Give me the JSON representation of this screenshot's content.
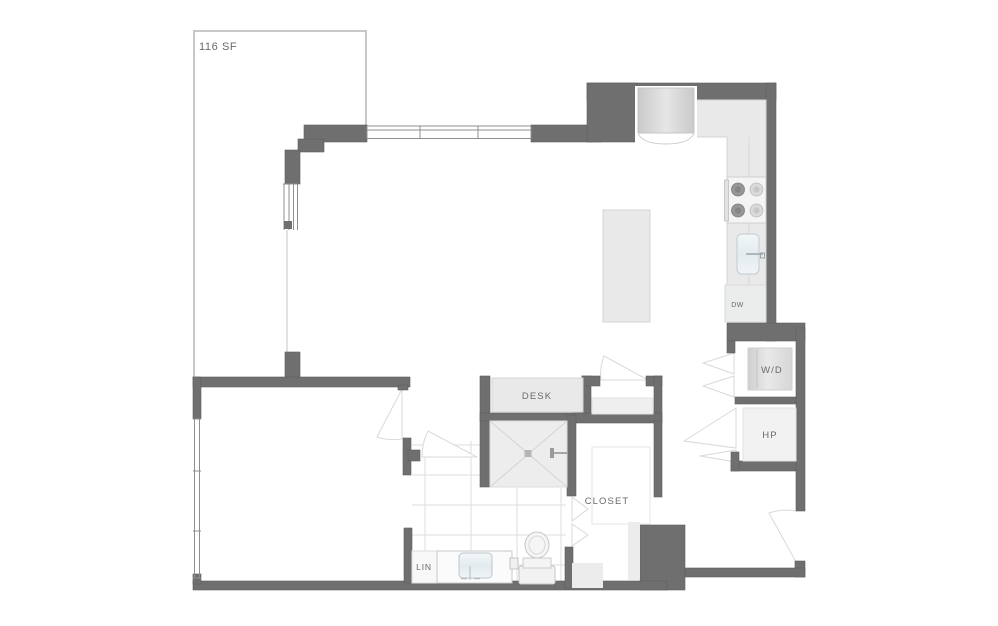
{
  "floorplan": {
    "balcony": {
      "area_label": "116 SF"
    },
    "labels": {
      "desk": "DESK",
      "closet": "CLOSET",
      "linen": "LIN",
      "washer_dryer": "W/D",
      "heat_pump": "HP",
      "dishwasher": "DW"
    },
    "colors": {
      "background": "#ffffff",
      "wall": "#6f6f6f",
      "wall_edge": "#5f5f5f",
      "fixture_fill": "#e9e9e9",
      "fixture_border": "#d4d4d4",
      "balcony_outline": "#c8c8c8",
      "window_line": "#8f8f8f",
      "door_swing": "#d9d9d9",
      "tile_line": "#dcdcdc",
      "label_text": "#68696b",
      "sink_fill": "#e9eff2",
      "burner_dark": "#969696",
      "burner_light": "#d9d9d9"
    }
  }
}
